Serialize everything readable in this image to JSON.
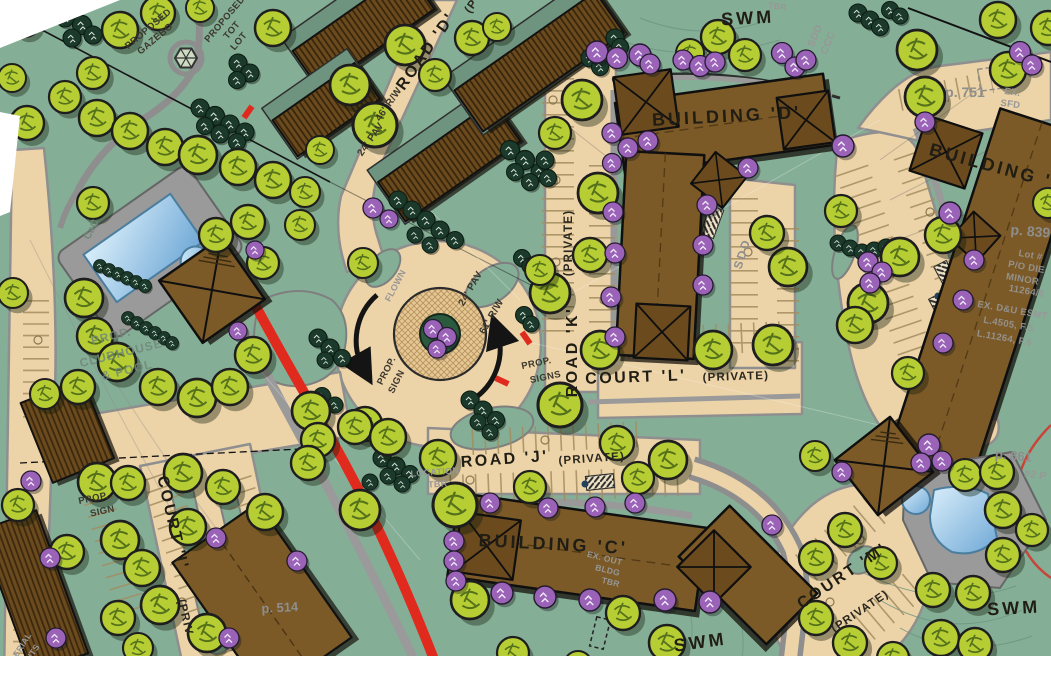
{
  "palette": {
    "grass": "#85AE96",
    "pavement": "#ECD3A8",
    "road_gray": "#8E8E8E",
    "building_brown": "#7B5A27",
    "townhouse_brown": "#6B4A1E",
    "tree_green": "#B6CE33",
    "tree_purple": "#9A63B8",
    "evergreen": "#1C3A2B",
    "water_blue": "#A9D3EF",
    "accent_red": "#E02A1E",
    "ink": "#1B1B1B",
    "faint_gray": "#8E8E8E"
  },
  "labels": {
    "buildings": {
      "c": "BUILDING 'C'",
      "d": "BUILDING 'D'",
      "e": "BUILDING 'E'"
    },
    "roads": {
      "road_d": "ROAD 'D'",
      "road_d_more": "(P",
      "road_k": "ROAD 'K'",
      "road_k_private": "(PRIVATE)",
      "road_j": "ROAD 'J'",
      "road_j_private": "(PRIVATE)",
      "court_l": "COURT 'L'",
      "court_l_private": "(PRIVATE)",
      "court_i": "COURT 'I'",
      "court_i_private": "(PRIV",
      "court_m": "COURT 'M'",
      "court_m_private": "(PRIVATE)"
    },
    "dimensions": {
      "road_d_rw": "46' R/W",
      "road_d_pav": "24' PAV",
      "roundabout_pav": "24' PAV",
      "roundabout_rw": "61' R/W"
    },
    "amenities": {
      "swm_north": "SWM",
      "swm_south": "SWM",
      "swm_southeast": "SWM",
      "proposed_gazebo_line1": "PROPOSED",
      "proposed_gazebo_line2": "GAZEBO",
      "tot_lot_line1": "PROPOSED",
      "tot_lot_line2": "TOT",
      "tot_lot_line3": "LOT",
      "clubhouse_line1": "PROP.",
      "clubhouse_line2": "CLUBHOUSE",
      "clubhouse_line3": "& POOL"
    },
    "signs": {
      "west_line1": "PROP.",
      "west_line2": "SIGN",
      "east_line1": "PROP.",
      "east_line2": "SIGNS",
      "southwest_line1": "PROP.",
      "southwest_line2": "SIGN"
    },
    "parcels": {
      "p751": "p. 751",
      "p839": "p. 839",
      "p861": "p. 861",
      "p514": "p. 514"
    },
    "annotations": {
      "ex_sfd_line1": "EX.",
      "ex_sfd_line2": "SFD",
      "sdd": "SDD",
      "sdd_ccc_line1": "SDD",
      "sdd_ccc_line2": "CCC",
      "tbr": "TBR",
      "cac": "CaC",
      "flown": "FLOWN",
      "aerial_line1": "AERIAL",
      "aerial_line2": "LIMITS",
      "location_line1": "LOCATION",
      "location_line2": "TBR",
      "ex_out_line1": "EX. OUT",
      "ex_out_line2": "BLDG",
      "ex_out_line3": "TBR",
      "lot_line1": "Lot #",
      "lot_line2": "P/O DIE",
      "lot_line3": "MINOR",
      "lot_line4": "11264/6",
      "esmt_line1": "EX. D&U ESMT",
      "esmt_line2": "L.4505, F.5",
      "esmt_line3": "L.11264, F.6",
      "parcel2": "#2 P"
    }
  }
}
